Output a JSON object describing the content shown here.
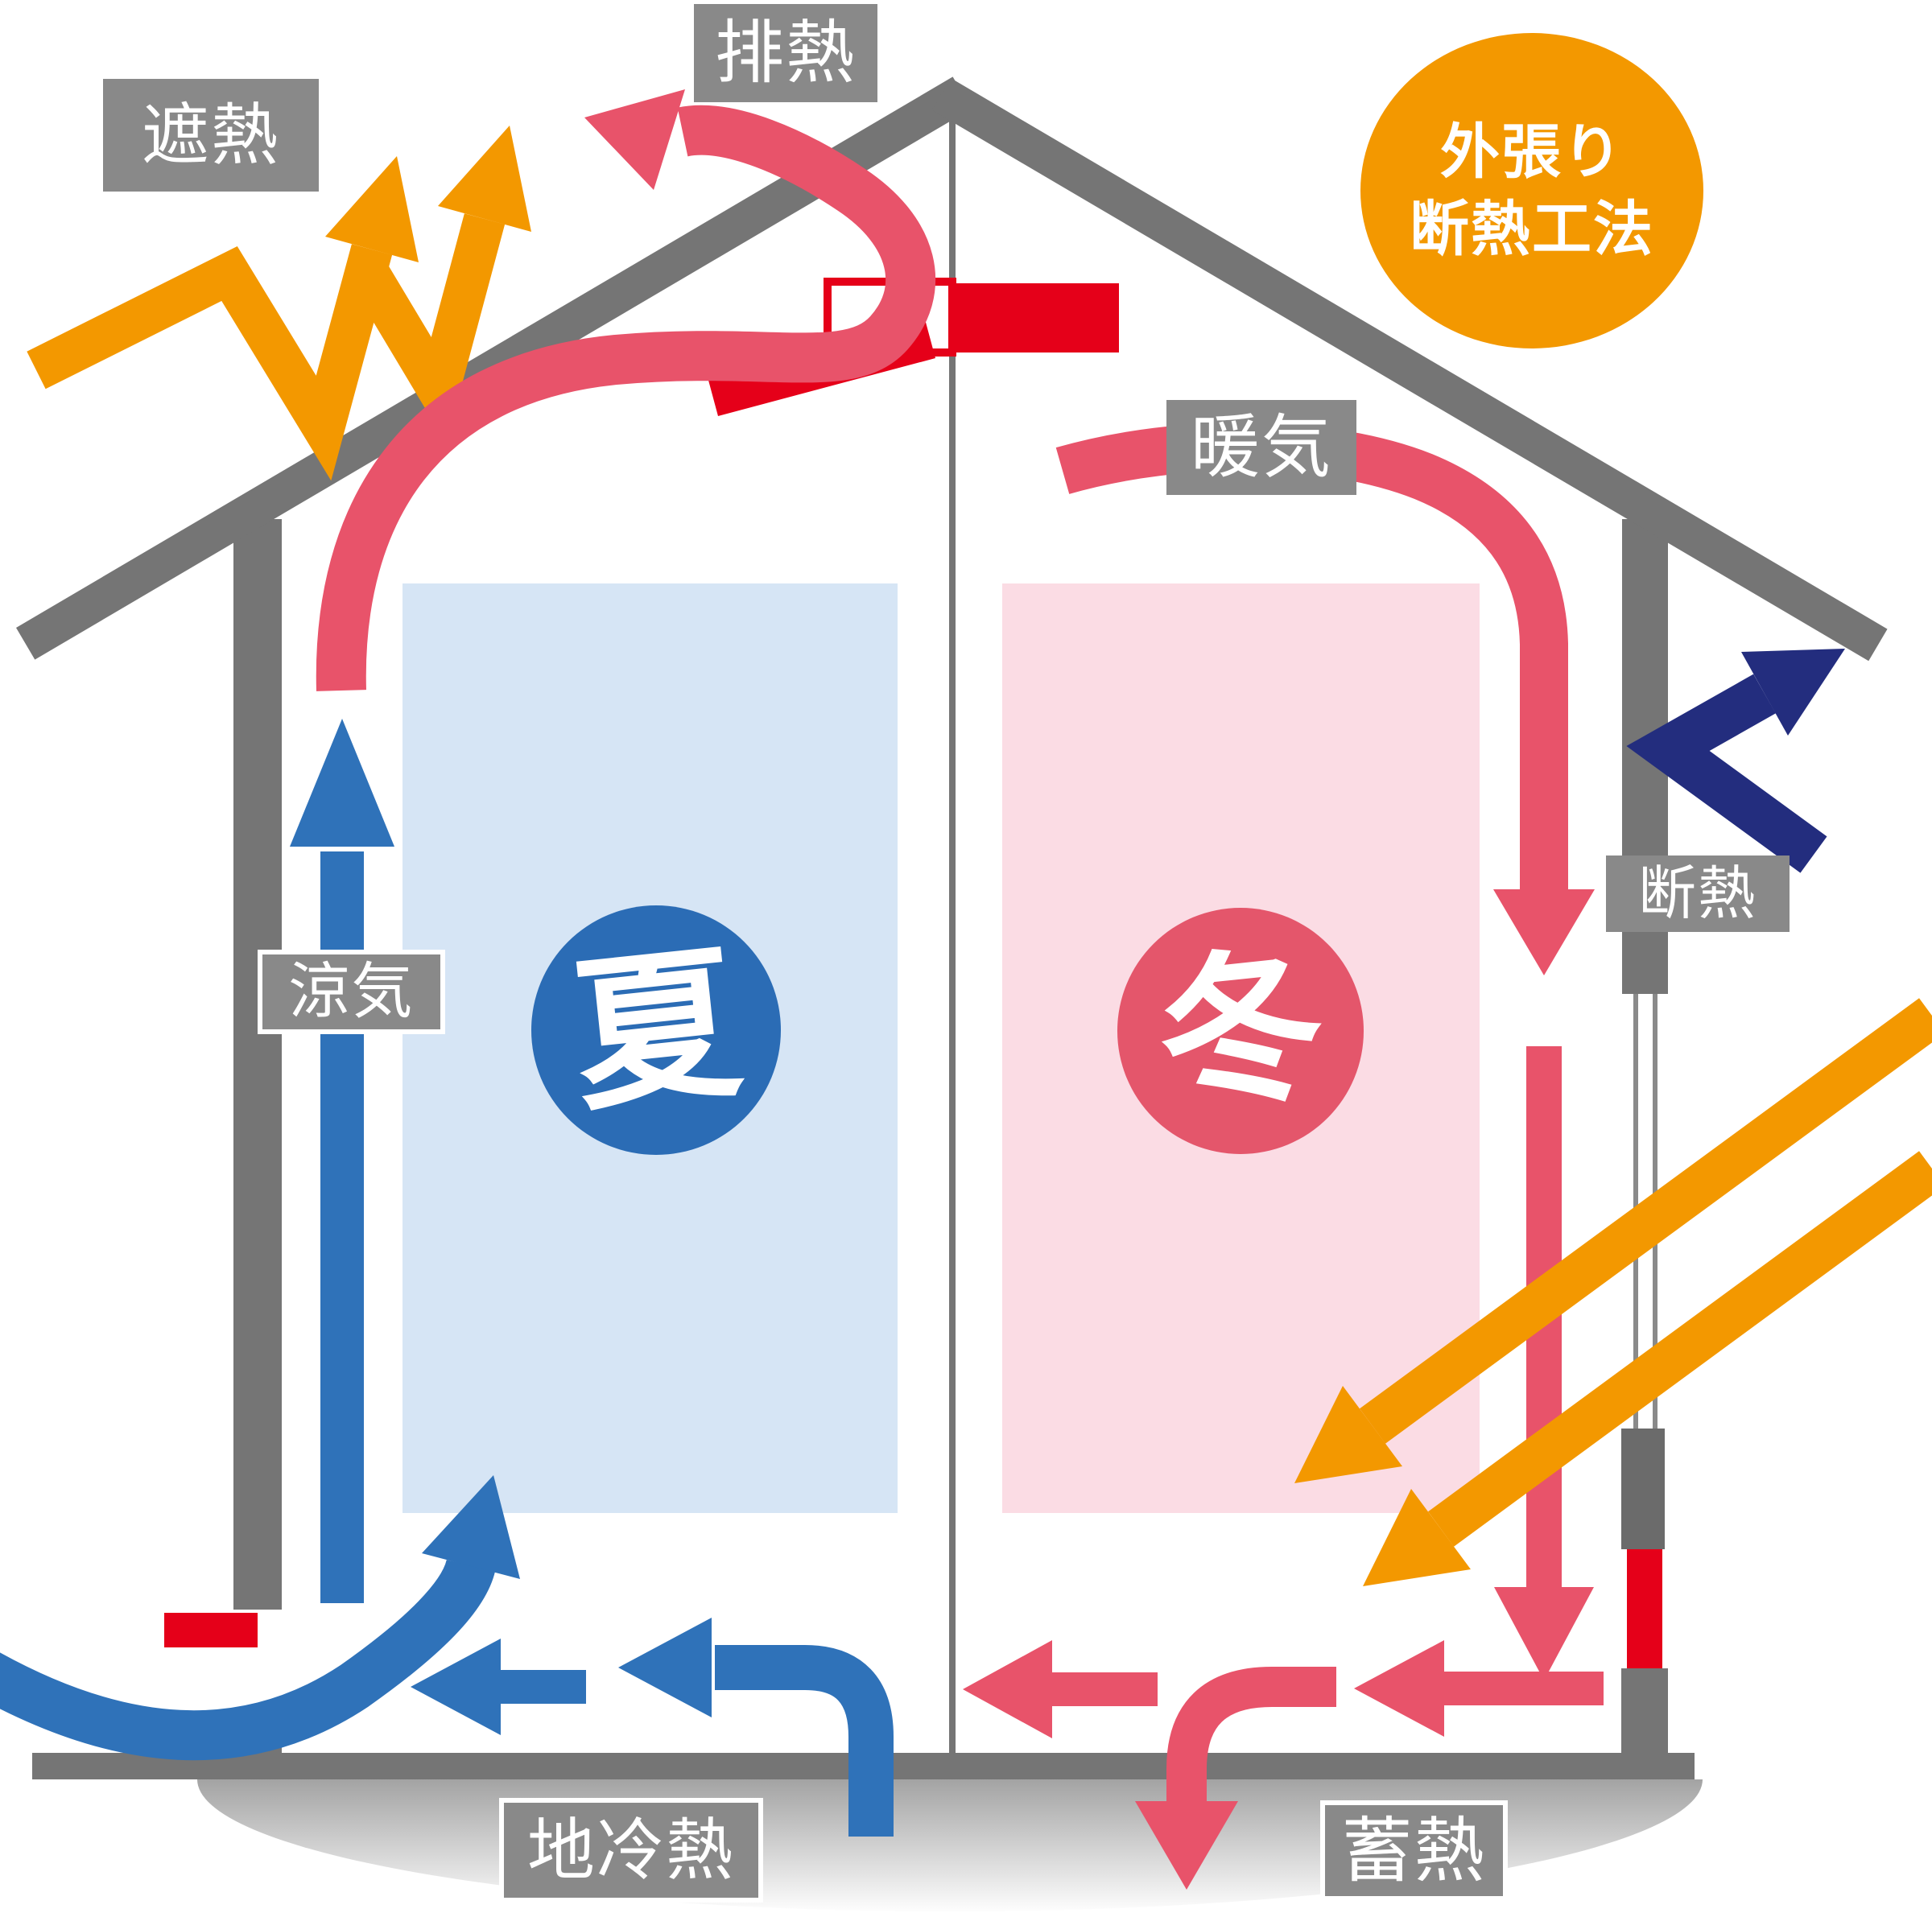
{
  "method_badge": {
    "line1": "外張り",
    "line2": "断熱工法"
  },
  "labels": {
    "exhaust": {
      "text": "排熱"
    },
    "shield": {
      "text": "遮熱"
    },
    "warm_air": {
      "text": "暖気"
    },
    "insulation": {
      "text": "断熱"
    },
    "cool_air": {
      "text": "涼気"
    },
    "ground_cool": {
      "text": "地冷熱"
    },
    "heat_storage": {
      "text": "蓄熱"
    }
  },
  "seasons": {
    "summer": {
      "text": "夏"
    },
    "winter": {
      "text": "冬"
    }
  },
  "icons": {
    "exhaust-arrow": {
      "meaning": "summer hot air escaping through ridge vent",
      "color": "#E8536A"
    },
    "warm-air-arrow": {
      "meaning": "winter warm air circulating down inside wall",
      "color": "#E8536A"
    },
    "heat-storage-arrows": {
      "meaning": "warm air flowing along floor and stored into ground",
      "color": "#E8536A"
    },
    "sun-ray-arrows": {
      "meaning": "winter sunlight entering through window",
      "color": "#F39800"
    },
    "shield-zigzag-arrows": {
      "meaning": "summer sunlight reflected off roof",
      "color": "#F39800"
    },
    "insulation-bounce-arrow": {
      "meaning": "outside heat rejected by exterior insulation",
      "color": "#232D7E"
    },
    "cool-air-arrows": {
      "meaning": "cool air rising from ground and circulating",
      "color": "#2F72B9"
    },
    "ridge-vent": {
      "meaning": "red ridge ventilation damper",
      "color": "#E50019"
    }
  },
  "colors": {
    "pink_arrow": "#E8536A",
    "vivid_red": "#E50019",
    "orange": "#F39800",
    "blue": "#2F72B9",
    "navy": "#232D7E",
    "structure_gray": "#757575",
    "label_gray": "#898989",
    "summer_zone": "#D6E5F5",
    "winter_zone": "#FBDCE4",
    "summer_circle": "#2B6CB5",
    "winter_circle": "#E4566B"
  }
}
